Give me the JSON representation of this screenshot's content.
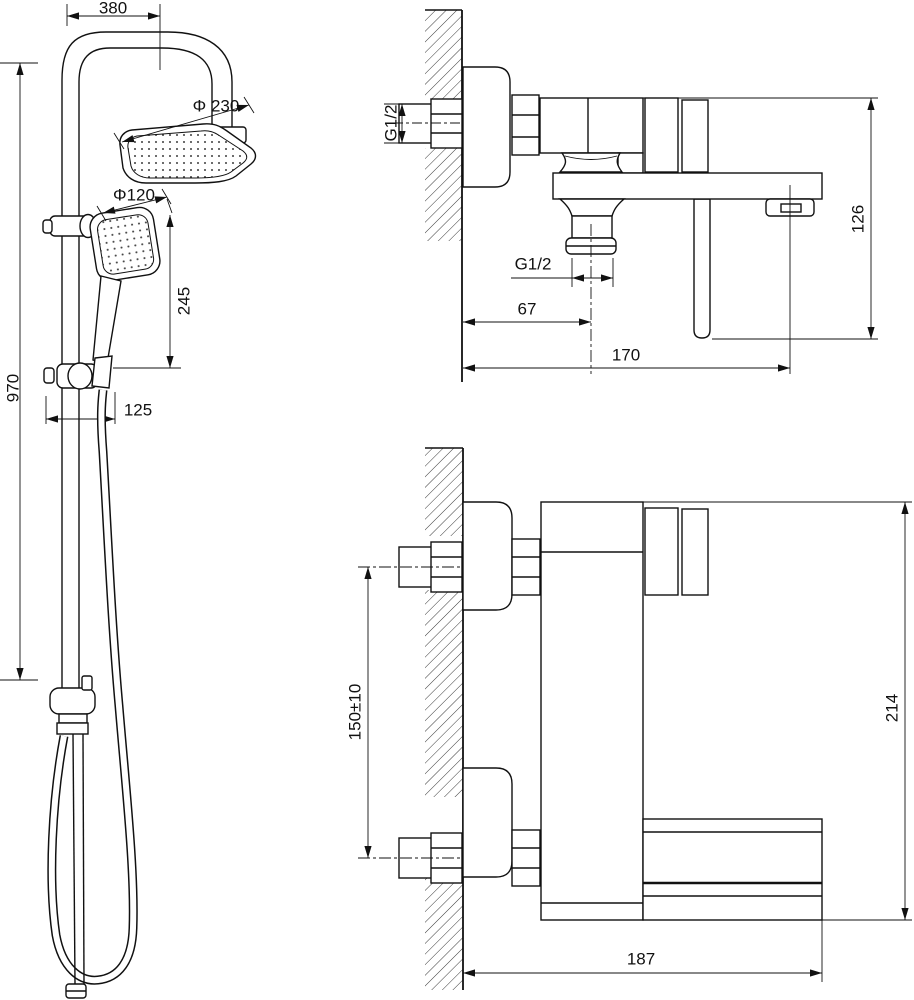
{
  "meta": {
    "description": "Technical dimension drawing of shower column and wall-mounted bath mixer",
    "background_color": "#ffffff",
    "line_color": "#111111"
  },
  "views": {
    "column": {
      "title": "shower-column-front-view",
      "dims": {
        "arm_reach": "380",
        "head_diameter": "Φ 230",
        "hand_shower_diameter": "Φ120",
        "hand_shower_length": "245",
        "column_height": "970",
        "bracket_offset": "125"
      }
    },
    "mixer_side": {
      "title": "mixer-side-view",
      "dims": {
        "inlet_thread": "G1/2",
        "outlet_thread": "G1/2",
        "outlet_offset": "67",
        "spout_reach": "170",
        "body_drop": "126"
      }
    },
    "mixer_front": {
      "title": "mixer-front-view",
      "dims": {
        "inlet_spacing": "150±10",
        "overall_height": "214",
        "overall_width": "187"
      }
    }
  }
}
